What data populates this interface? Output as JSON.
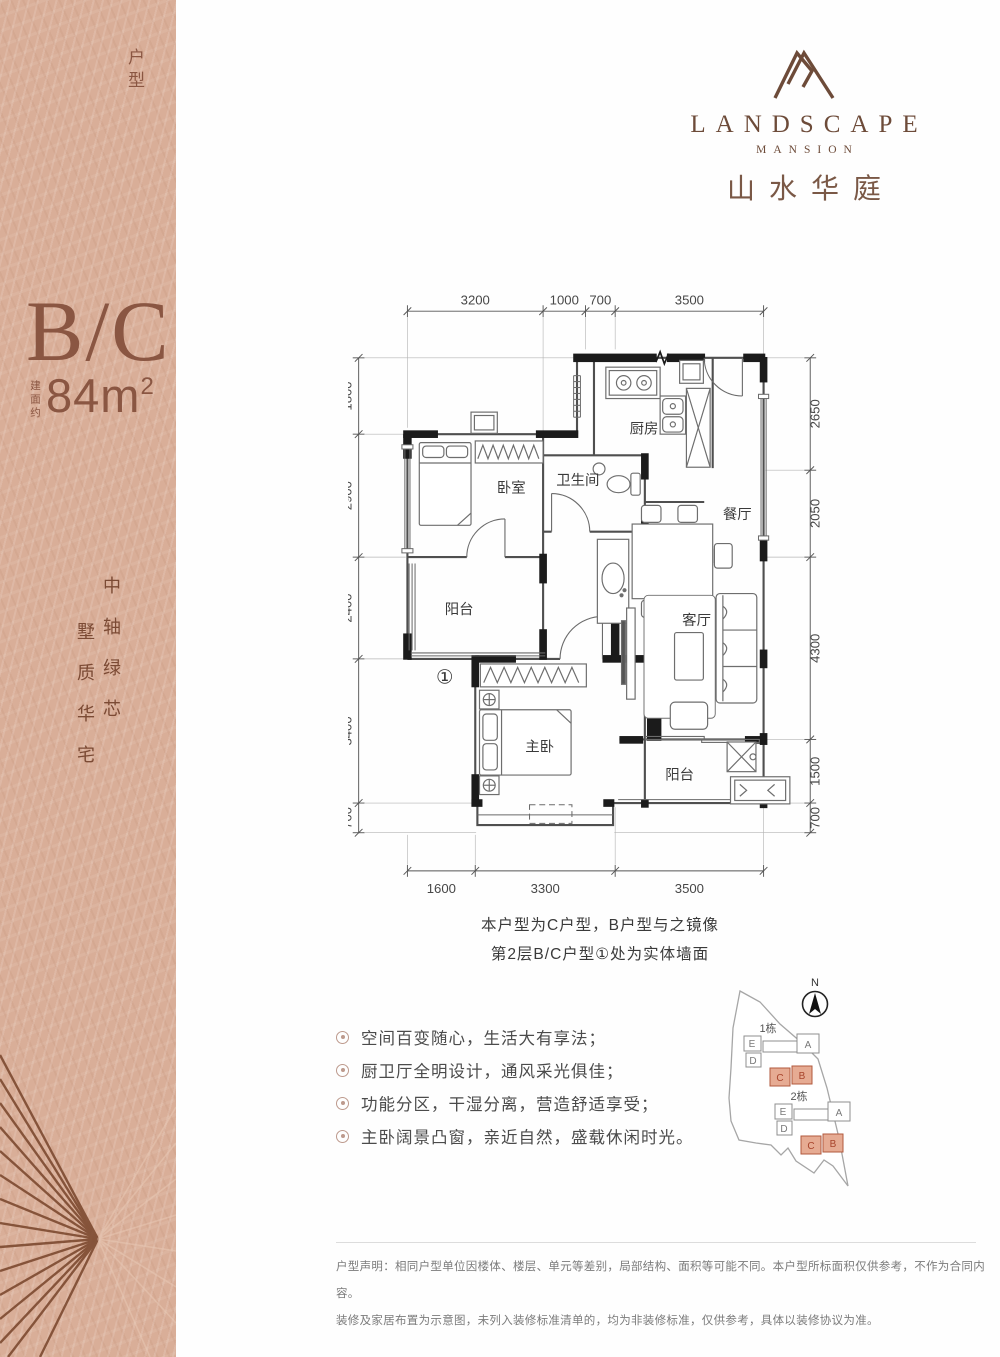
{
  "brand": {
    "logo_icon": "mountain-monogram",
    "name_en": "LANDSCAPE",
    "subtitle_en": "MANSION",
    "name_cn": "山水华庭"
  },
  "unit_info": {
    "type_label": "B/C",
    "type_suffix": "户型",
    "area_prefix": "建面约",
    "area_value": "84m",
    "area_exponent": "2"
  },
  "slogan": {
    "part1": "中轴绿芯",
    "part2": "墅质华宅"
  },
  "floor_plan": {
    "rooms": {
      "kitchen": "厨房",
      "bedroom": "卧室",
      "bathroom": "卫生间",
      "dining": "餐厅",
      "balcony_front": "阳台",
      "living": "客厅",
      "master": "主卧",
      "balcony_back": "阳台"
    },
    "marker": "①",
    "dims_top": [
      "3200",
      "1000",
      "700",
      "3500"
    ],
    "dims_left": [
      "1800",
      "2900",
      "2400",
      "3400",
      "700"
    ],
    "dims_right": [
      "2650",
      "2050",
      "4300",
      "1500",
      "700"
    ],
    "dims_bottom": [
      "1600",
      "3300",
      "3500"
    ]
  },
  "plan_notes": {
    "line1": "本户型为C户型，B户型与之镜像",
    "line2": "第2层B/C户型①处为实体墙面"
  },
  "features": [
    {
      "text": "空间百变随心，生活大有享法；"
    },
    {
      "text": "厨卫厅全明设计，通风采光俱佳；"
    },
    {
      "text": "功能分区，干湿分离，营造舒适享受；"
    },
    {
      "text": "主卧阔景凸窗，亲近自然，盛载休闲时光。"
    }
  ],
  "site_plan": {
    "north_label": "N",
    "cluster1_label": "1栋",
    "cluster2_label": "2栋",
    "unit_letters": [
      "E",
      "D",
      "A",
      "C",
      "B"
    ],
    "highlighted_units": "C、B"
  },
  "disclaimer": {
    "line1": "户型声明：相同户型单位因楼体、楼层、单元等差别，局部结构、面积等可能不同。本户型所标面积仅供参考，不作为合同内容。",
    "line2": "装修及家居布置为示意图，未列入装修标准清单的，均为非装修标准，仅供参考，具体以装修协议为准。"
  },
  "colors": {
    "sidebar_bg": "#d9ae98",
    "fan_line": "#7d4a30",
    "brand_brown": "#6d4b39",
    "accent_brown": "#8a5642",
    "plan_wall": "#4f4f4f",
    "wall_black": "#1b1b1b",
    "highlight_fill": "#e6ab93",
    "highlight_stroke": "#b25a3e"
  }
}
